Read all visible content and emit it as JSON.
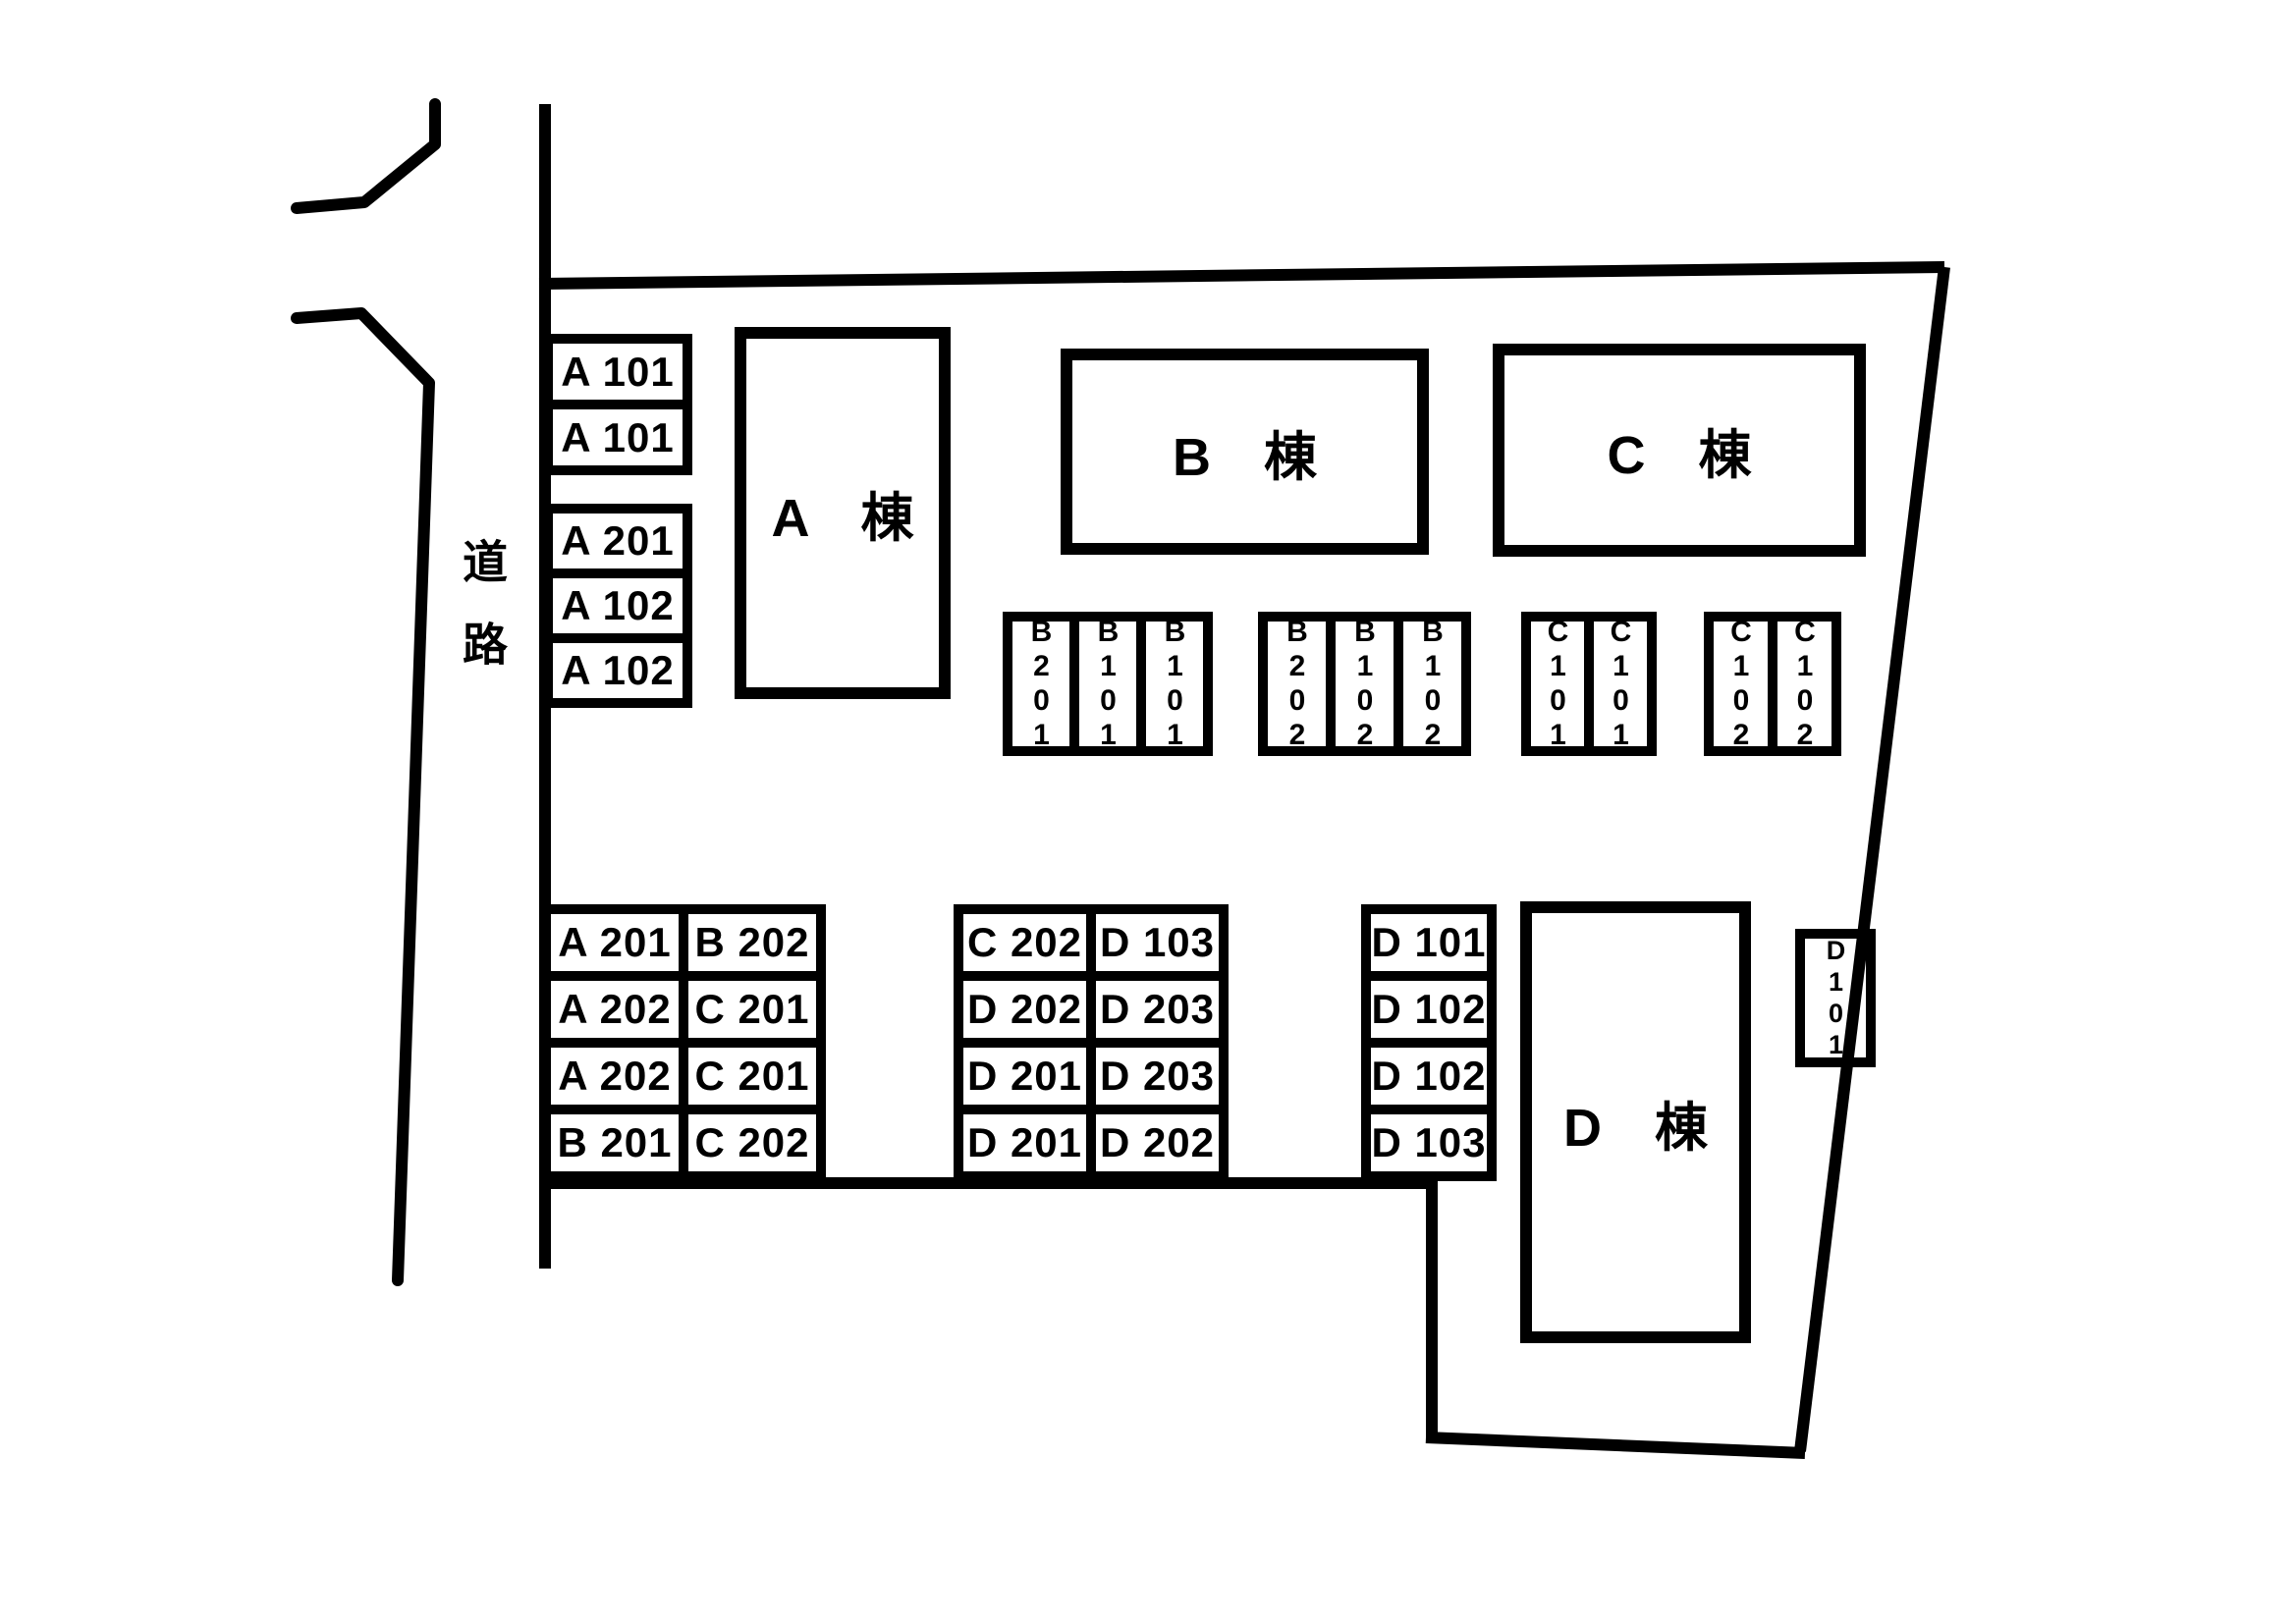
{
  "colors": {
    "ink": "#000000",
    "background": "#ffffff"
  },
  "road": {
    "label": "道路"
  },
  "buildings": {
    "a": {
      "label": "A　棟"
    },
    "b": {
      "label": "B　棟"
    },
    "c": {
      "label": "C　棟"
    },
    "d": {
      "label": "D　棟"
    }
  },
  "parking": {
    "roadside_top": [
      "A 101",
      "A 101"
    ],
    "roadside_bottom": [
      "A 201",
      "A 102",
      "A 102"
    ],
    "b_group_1": [
      "B201",
      "B101",
      "B101"
    ],
    "b_group_2": [
      "B202",
      "B102",
      "B102"
    ],
    "c_group_1": [
      "C101",
      "C101"
    ],
    "c_group_2": [
      "C102",
      "C102"
    ],
    "southwest_grid": [
      [
        "A 201",
        "B 202"
      ],
      [
        "A 202",
        "C 201"
      ],
      [
        "A 202",
        "C 201"
      ],
      [
        "B 201",
        "C 202"
      ]
    ],
    "south_center_grid": [
      [
        "C 202",
        "D 103"
      ],
      [
        "D 202",
        "D 203"
      ],
      [
        "D 201",
        "D 203"
      ],
      [
        "D 201",
        "D 202"
      ]
    ],
    "south_east_column": [
      "D 101",
      "D 102",
      "D 102",
      "D 103"
    ],
    "east_standalone": "D101"
  }
}
